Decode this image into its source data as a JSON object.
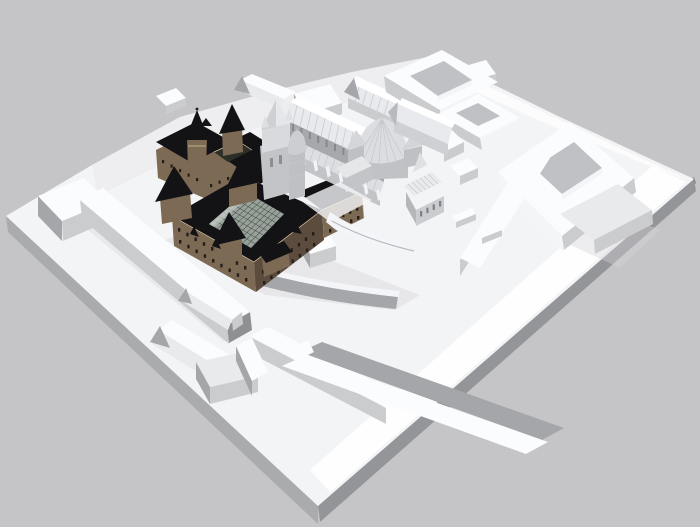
{
  "scene": {
    "type": "3d-architectural-massing-model",
    "objects": [
      {
        "name": "terrain-plinth",
        "description": "white site model base"
      },
      {
        "name": "massing-blocks",
        "description": "abstract white context buildings, several with inner courtyards"
      },
      {
        "name": "castle-quad",
        "description": "detailed brick building with black roofs and glazed courtyard roof"
      },
      {
        "name": "castle-northwest-wing",
        "description": "gatehouse wing with conical spire towers"
      },
      {
        "name": "church",
        "description": "light gray basilica with west tower, ribbed nave roof and domed rotunda"
      },
      {
        "name": "small-chapel",
        "description": "small chapel with arched windows"
      }
    ]
  },
  "palette": {
    "bg": "#c5c5c7",
    "terrainTop": "#f3f4f6",
    "terrainHi": "#ffffff",
    "terrainSideL": "#aaabad",
    "terrainSideR": "#949598",
    "terrainRim": "#85868a",
    "shade": "#d4d5d9",
    "blockTop": "#fbfcfe",
    "blockLight": "#e9eaec",
    "blockMid": "#cbccce",
    "blockGray": "#a5a6a9",
    "blockDark": "#8f9093",
    "courtFloor": "#c0c1c5",
    "courtBright": "#f4f5f8",
    "castleWall": "#7d6a55",
    "castleWallDark": "#5c4c3e",
    "castleRoof": "#131316",
    "castleTrim": "#d8c8a3",
    "castleWin": "#261f19",
    "glass": "#98a29b",
    "glassLine": "#3c443e",
    "glassHi": "#c9d1c9",
    "chWall": "#c3c4c7",
    "chWallDk": "#a7a8ab",
    "chRoof": "#e9eaed",
    "chRoofSh": "#dddee1",
    "rib": "#c6c7ca",
    "slit": "#87888c",
    "fin": "#f2f3f5"
  }
}
